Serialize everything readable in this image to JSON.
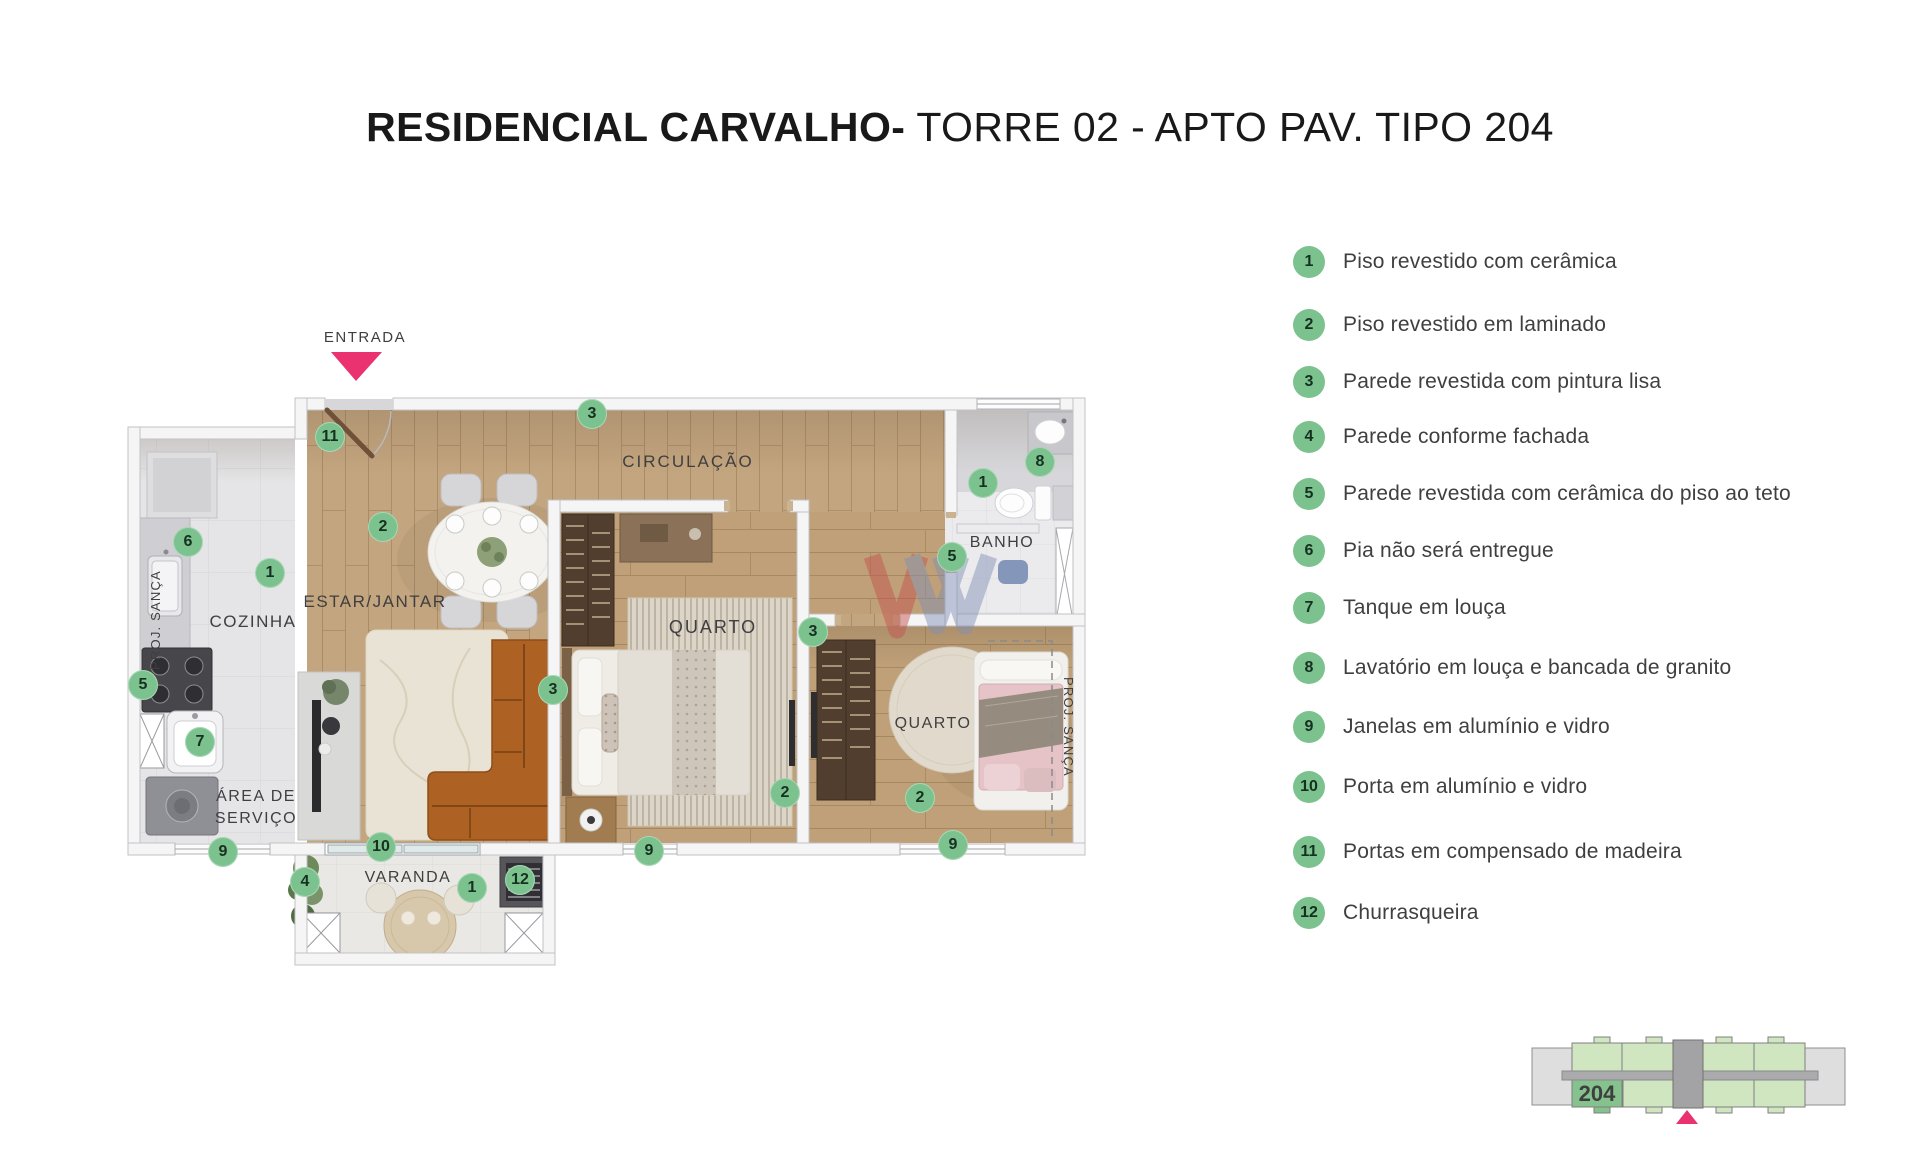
{
  "title": {
    "bold": "RESIDENCIAL CARVALHO-",
    "regular": " TORRE 02 - APTO PAV. TIPO 204"
  },
  "plan": {
    "entrance_label": "ENTRADA",
    "rooms": {
      "kitchen": "COZINHA",
      "living": "ESTAR/JANTAR",
      "circulation": "CIRCULAÇÃO",
      "bedroom1": "QUARTO",
      "bedroom2": "QUARTO",
      "bathroom": "BANHO",
      "service_line1": "ÁREA DE",
      "service_line2": "SERVIÇO",
      "balcony": "VARANDA",
      "proj_sanca_left": "PROJ. SANÇA",
      "proj_sanca_right": "PROJ. SANÇA"
    },
    "markers": [
      {
        "n": "11",
        "x": 330,
        "y": 437
      },
      {
        "n": "3",
        "x": 592,
        "y": 414
      },
      {
        "n": "2",
        "x": 383,
        "y": 527
      },
      {
        "n": "6",
        "x": 188,
        "y": 542
      },
      {
        "n": "1",
        "x": 270,
        "y": 573
      },
      {
        "n": "5",
        "x": 143,
        "y": 685
      },
      {
        "n": "7",
        "x": 200,
        "y": 742
      },
      {
        "n": "9",
        "x": 223,
        "y": 852
      },
      {
        "n": "4",
        "x": 305,
        "y": 882
      },
      {
        "n": "10",
        "x": 381,
        "y": 847
      },
      {
        "n": "1",
        "x": 472,
        "y": 888
      },
      {
        "n": "12",
        "x": 520,
        "y": 880
      },
      {
        "n": "3",
        "x": 553,
        "y": 690
      },
      {
        "n": "9",
        "x": 649,
        "y": 851
      },
      {
        "n": "2",
        "x": 785,
        "y": 793
      },
      {
        "n": "3",
        "x": 813,
        "y": 632
      },
      {
        "n": "2",
        "x": 920,
        "y": 798
      },
      {
        "n": "9",
        "x": 953,
        "y": 845
      },
      {
        "n": "1",
        "x": 983,
        "y": 483
      },
      {
        "n": "8",
        "x": 1040,
        "y": 462
      },
      {
        "n": "5",
        "x": 952,
        "y": 557
      }
    ]
  },
  "legend": {
    "items": [
      {
        "num": "1",
        "text": "Piso revestido com cerâmica",
        "y": 262
      },
      {
        "num": "2",
        "text": "Piso revestido em laminado",
        "y": 325
      },
      {
        "num": "3",
        "text": "Parede revestida com pintura lisa",
        "y": 382
      },
      {
        "num": "4",
        "text": "Parede conforme fachada",
        "y": 437
      },
      {
        "num": "5",
        "text": "Parede revestida com cerâmica do piso ao teto",
        "y": 494
      },
      {
        "num": "6",
        "text": "Pia não será entregue",
        "y": 551
      },
      {
        "num": "7",
        "text": "Tanque em louça",
        "y": 608
      },
      {
        "num": "8",
        "text": "Lavatório em louça e bancada de granito",
        "y": 668
      },
      {
        "num": "9",
        "text": "Janelas em alumínio e vidro",
        "y": 727
      },
      {
        "num": "10",
        "text": "Porta em alumínio e vidro",
        "y": 787
      },
      {
        "num": "11",
        "text": "Portas em compensado de madeira",
        "y": 852
      },
      {
        "num": "12",
        "text": "Churrasqueira",
        "y": 913
      }
    ]
  },
  "keyplan": {
    "unit": "204"
  },
  "colors": {
    "marker_green": "#7cc28f",
    "accent_pink": "#e9326f"
  }
}
